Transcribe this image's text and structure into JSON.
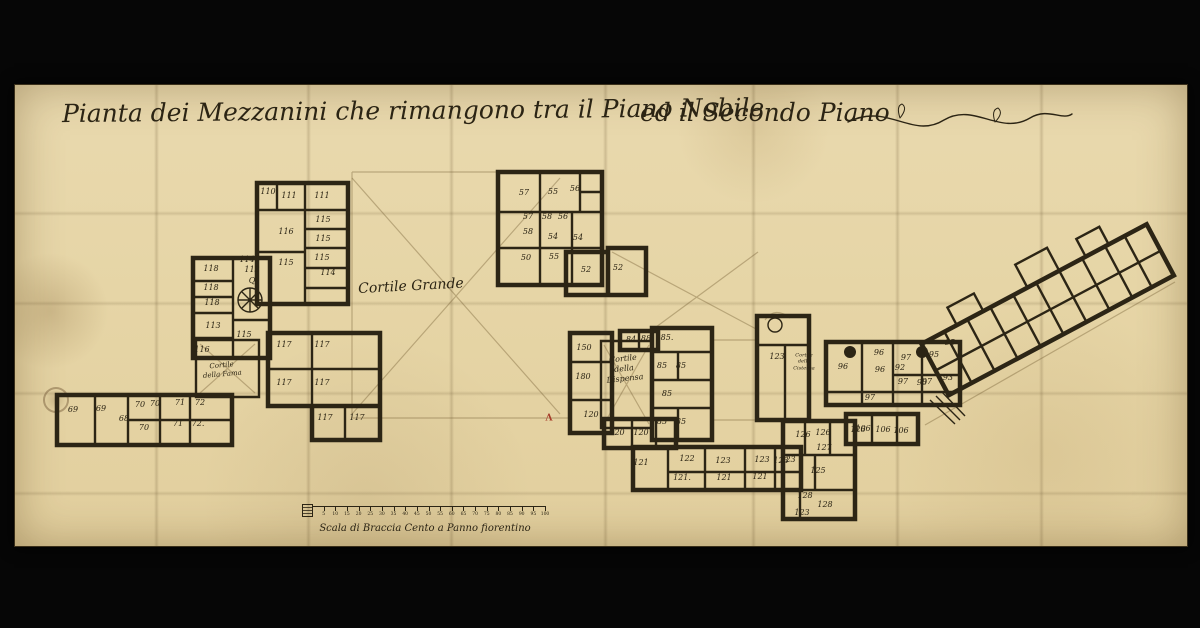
{
  "document": {
    "title": {
      "part1": "Pianta dei Mezzanini che rimangono tra il Piano Nobile",
      "part2": "ed il Secondo Piano"
    }
  },
  "plan": {
    "courtyards": [
      {
        "name": "cortile-grande",
        "lines": [
          "Cortile Grande"
        ],
        "x": 411,
        "y": 287,
        "fs": 14,
        "rot": -3
      },
      {
        "name": "cortile-della-fama",
        "lines": [
          "Cortile",
          "della Fama"
        ],
        "x": 222,
        "y": 370,
        "fs": 7,
        "rot": -5
      },
      {
        "name": "cortile-della-dispensa",
        "lines": [
          "Cortile",
          "della",
          "Dispensa"
        ],
        "x": 624,
        "y": 369,
        "fs": 8,
        "rot": -6
      },
      {
        "name": "cortile-della-cisterna",
        "lines": [
          "Cortile",
          "della",
          "Cisterna"
        ],
        "x": 804,
        "y": 362,
        "fs": 5,
        "rot": 0
      }
    ],
    "rooms": [
      {
        "n": "110",
        "x": 268,
        "y": 192
      },
      {
        "n": "111",
        "x": 289,
        "y": 196
      },
      {
        "n": "111",
        "x": 322,
        "y": 196
      },
      {
        "n": "115",
        "x": 323,
        "y": 220
      },
      {
        "n": "116",
        "x": 286,
        "y": 232
      },
      {
        "n": "115",
        "x": 323,
        "y": 239
      },
      {
        "n": "115",
        "x": 322,
        "y": 258
      },
      {
        "n": "115",
        "x": 286,
        "y": 263
      },
      {
        "n": "114",
        "x": 328,
        "y": 273
      },
      {
        "n": "114",
        "x": 247,
        "y": 260
      },
      {
        "n": "118",
        "x": 211,
        "y": 269
      },
      {
        "n": "113",
        "x": 252,
        "y": 270
      },
      {
        "n": "Q",
        "x": 252,
        "y": 281
      },
      {
        "n": "118",
        "x": 211,
        "y": 288
      },
      {
        "n": "118",
        "x": 212,
        "y": 303
      },
      {
        "n": "113",
        "x": 213,
        "y": 326
      },
      {
        "n": "115",
        "x": 244,
        "y": 335
      },
      {
        "n": "116",
        "x": 202,
        "y": 350
      },
      {
        "n": "117",
        "x": 284,
        "y": 345
      },
      {
        "n": "117",
        "x": 322,
        "y": 345
      },
      {
        "n": "117",
        "x": 284,
        "y": 383
      },
      {
        "n": "117",
        "x": 322,
        "y": 383
      },
      {
        "n": "117",
        "x": 325,
        "y": 418
      },
      {
        "n": "117",
        "x": 357,
        "y": 418
      },
      {
        "n": "69",
        "x": 73,
        "y": 410
      },
      {
        "n": "69",
        "x": 101,
        "y": 409
      },
      {
        "n": "70",
        "x": 140,
        "y": 405
      },
      {
        "n": "70",
        "x": 155,
        "y": 404
      },
      {
        "n": "71",
        "x": 180,
        "y": 403
      },
      {
        "n": "72",
        "x": 200,
        "y": 403
      },
      {
        "n": "68",
        "x": 124,
        "y": 419
      },
      {
        "n": "70",
        "x": 144,
        "y": 428
      },
      {
        "n": "71",
        "x": 178,
        "y": 424
      },
      {
        "n": "72.",
        "x": 198,
        "y": 424
      },
      {
        "n": "57",
        "x": 524,
        "y": 193
      },
      {
        "n": "55",
        "x": 553,
        "y": 192
      },
      {
        "n": "56",
        "x": 575,
        "y": 189
      },
      {
        "n": "57",
        "x": 528,
        "y": 217
      },
      {
        "n": "58",
        "x": 547,
        "y": 217
      },
      {
        "n": "56",
        "x": 563,
        "y": 217
      },
      {
        "n": "58",
        "x": 528,
        "y": 232
      },
      {
        "n": "54",
        "x": 553,
        "y": 237
      },
      {
        "n": "54",
        "x": 578,
        "y": 238
      },
      {
        "n": "50",
        "x": 526,
        "y": 258
      },
      {
        "n": "55",
        "x": 554,
        "y": 257
      },
      {
        "n": "52",
        "x": 586,
        "y": 270
      },
      {
        "n": "52",
        "x": 618,
        "y": 268
      },
      {
        "n": "150",
        "x": 584,
        "y": 348
      },
      {
        "n": "180",
        "x": 583,
        "y": 377
      },
      {
        "n": "120",
        "x": 591,
        "y": 415
      },
      {
        "n": "120",
        "x": 617,
        "y": 433
      },
      {
        "n": "120",
        "x": 641,
        "y": 433
      },
      {
        "n": "84",
        "x": 631,
        "y": 340
      },
      {
        "n": "88",
        "x": 646,
        "y": 339
      },
      {
        "n": "85.",
        "x": 667,
        "y": 338
      },
      {
        "n": "85",
        "x": 662,
        "y": 366
      },
      {
        "n": "85",
        "x": 681,
        "y": 366
      },
      {
        "n": "85",
        "x": 667,
        "y": 394
      },
      {
        "n": "85",
        "x": 662,
        "y": 422
      },
      {
        "n": "85",
        "x": 681,
        "y": 422
      },
      {
        "n": "121",
        "x": 641,
        "y": 463
      },
      {
        "n": "122",
        "x": 687,
        "y": 459
      },
      {
        "n": "123",
        "x": 723,
        "y": 461
      },
      {
        "n": "123",
        "x": 762,
        "y": 460
      },
      {
        "n": "123",
        "x": 781,
        "y": 461
      },
      {
        "n": "121.",
        "x": 682,
        "y": 478
      },
      {
        "n": "121",
        "x": 724,
        "y": 478
      },
      {
        "n": "121",
        "x": 760,
        "y": 477
      },
      {
        "n": "123",
        "x": 777,
        "y": 357
      },
      {
        "n": "126",
        "x": 803,
        "y": 435
      },
      {
        "n": "126",
        "x": 823,
        "y": 433
      },
      {
        "n": "126",
        "x": 858,
        "y": 430
      },
      {
        "n": "127",
        "x": 824,
        "y": 448
      },
      {
        "n": "123",
        "x": 788,
        "y": 460
      },
      {
        "n": "125",
        "x": 818,
        "y": 471
      },
      {
        "n": "128",
        "x": 805,
        "y": 496
      },
      {
        "n": "128",
        "x": 825,
        "y": 505
      },
      {
        "n": "123",
        "x": 802,
        "y": 513
      },
      {
        "n": "96",
        "x": 843,
        "y": 367
      },
      {
        "n": "96",
        "x": 879,
        "y": 353
      },
      {
        "n": "96",
        "x": 880,
        "y": 370
      },
      {
        "n": "97",
        "x": 906,
        "y": 358
      },
      {
        "n": "92",
        "x": 900,
        "y": 368
      },
      {
        "n": "97",
        "x": 903,
        "y": 382
      },
      {
        "n": "90",
        "x": 922,
        "y": 383
      },
      {
        "n": "97",
        "x": 927,
        "y": 382
      },
      {
        "n": "95",
        "x": 934,
        "y": 355
      },
      {
        "n": "93",
        "x": 948,
        "y": 378
      },
      {
        "n": "97",
        "x": 870,
        "y": 398
      },
      {
        "n": "95",
        "x": 950,
        "y": 343
      },
      {
        "n": "106",
        "x": 863,
        "y": 429
      },
      {
        "n": "106",
        "x": 883,
        "y": 430
      },
      {
        "n": "106",
        "x": 901,
        "y": 431
      }
    ],
    "annotation_marks": [
      {
        "glyph": "Λ",
        "x": 549,
        "y": 419
      }
    ]
  },
  "scale_bar": {
    "caption": "Scala di Braccia Cento a Panno fiorentino",
    "tick_labels": [
      "5",
      "10",
      "15",
      "20",
      "25",
      "30",
      "35",
      "40",
      "45",
      "50",
      "55",
      "60",
      "65",
      "70",
      "75",
      "80",
      "85",
      "90",
      "95",
      "100"
    ]
  },
  "colors": {
    "paper": "#e8d7a9",
    "ink": "#2b2414",
    "wall": "#2c2515",
    "accent_red": "#a63b28",
    "background": "#060606"
  }
}
